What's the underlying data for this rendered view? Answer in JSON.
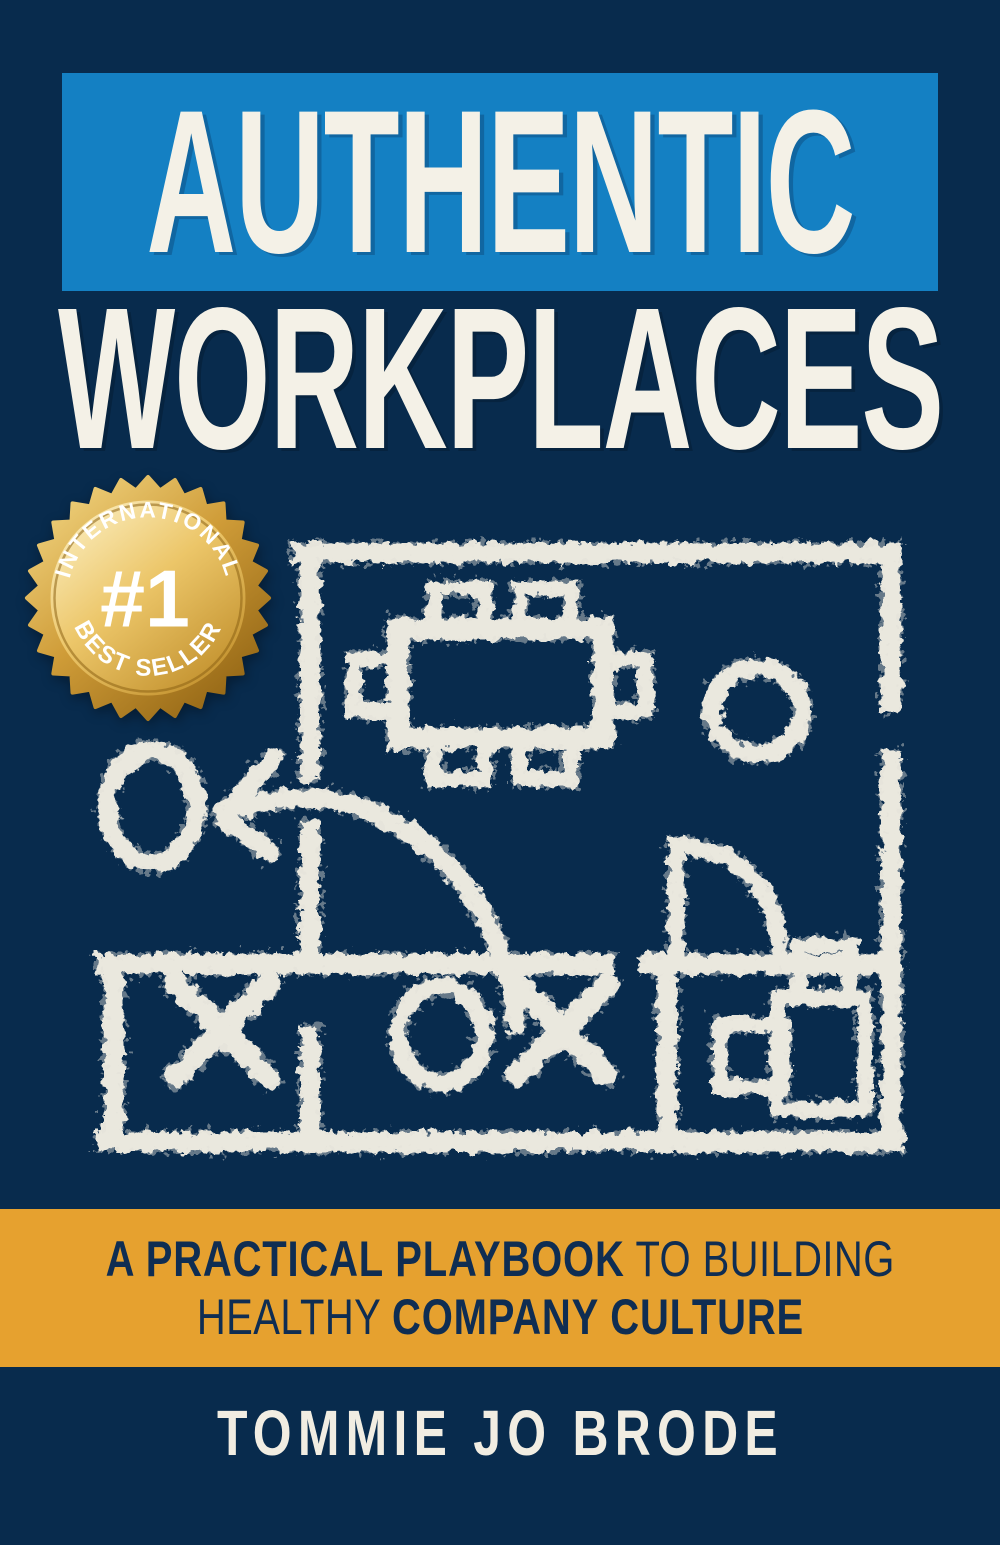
{
  "title": {
    "word1": "AUTHENTIC",
    "word2": "WORKPLACES"
  },
  "badge": {
    "arc_top": "INTERNATIONAL",
    "rank": "#1",
    "arc_bottom": "BEST SELLER"
  },
  "subtitle": {
    "line1_strong": "A PRACTICAL PLAYBOOK",
    "line1_light": " TO BUILDING",
    "line2_light": "HEALTHY ",
    "line2_strong": "COMPANY CULTURE"
  },
  "author": "TOMMIE JO BRODE",
  "illustration": "chalk-floorplan-playbook-diagram",
  "colors": {
    "navy_background": "#082b4d",
    "title_banner_blue": "#1480c3",
    "cream_text": "#f4f1e7",
    "subtitle_band_gold": "#e6a12f",
    "subtitle_text_navy": "#0f2d52",
    "chalk_stroke": "#f2eee3",
    "badge_gold_light": "#fcf0c4",
    "badge_gold_mid": "#e0b254",
    "badge_gold_dark": "#8f6212",
    "badge_text_white": "#ffffff"
  }
}
